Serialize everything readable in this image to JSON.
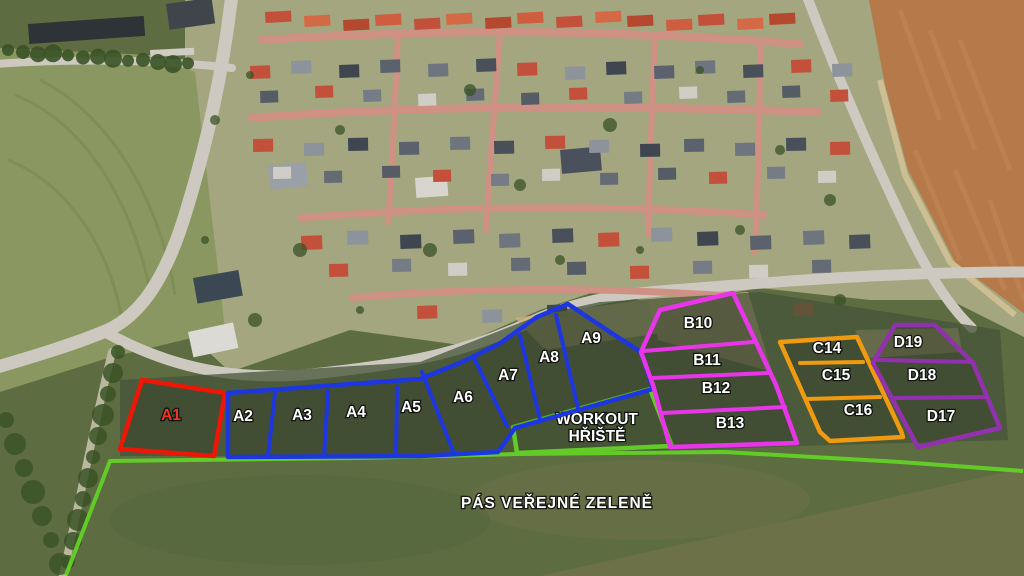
{
  "map": {
    "type": "aerial-parcel-plan",
    "overlay": {
      "parcel_groups": [
        {
          "id": "A-red",
          "color": "#ee1606",
          "label_color": "#f43418",
          "outline": [
            [
              142,
              380
            ],
            [
              225,
              393
            ],
            [
              214,
              456
            ],
            [
              120,
              449
            ]
          ],
          "dividers": [],
          "labels": [
            {
              "text": "A1",
              "xy": [
                171,
                420
              ]
            }
          ]
        },
        {
          "id": "A-blue",
          "color": "#1d36df",
          "label_color": "#ffffff",
          "outline": [
            [
              228,
              393
            ],
            [
              420,
              379
            ],
            [
              462,
              362
            ],
            [
              499,
              344
            ],
            [
              537,
              317
            ],
            [
              568,
              304
            ],
            [
              613,
              334
            ],
            [
              641,
              352
            ],
            [
              653,
              389
            ],
            [
              515,
              428
            ],
            [
              498,
              452
            ],
            [
              420,
              456
            ],
            [
              228,
              457
            ]
          ],
          "dividers": [
            [
              [
                275,
                393
              ],
              [
                268,
                456
              ]
            ],
            [
              [
                328,
                391
              ],
              [
                324,
                456
              ]
            ],
            [
              [
                397,
                387
              ],
              [
                396,
                455
              ]
            ],
            [
              [
                422,
                372
              ],
              [
                453,
                451
              ]
            ],
            [
              [
                473,
                356
              ],
              [
                507,
                426
              ]
            ],
            [
              [
                520,
                335
              ],
              [
                540,
                420
              ]
            ],
            [
              [
                556,
                315
              ],
              [
                578,
                408
              ]
            ]
          ],
          "labels": [
            {
              "text": "A2",
              "xy": [
                243,
                421
              ]
            },
            {
              "text": "A3",
              "xy": [
                302,
                420
              ]
            },
            {
              "text": "A4",
              "xy": [
                356,
                417
              ]
            },
            {
              "text": "A5",
              "xy": [
                411,
                412
              ]
            },
            {
              "text": "A6",
              "xy": [
                463,
                402
              ]
            },
            {
              "text": "A7",
              "xy": [
                508,
                380
              ]
            },
            {
              "text": "A8",
              "xy": [
                549,
                362
              ]
            },
            {
              "text": "A9",
              "xy": [
                591,
                343
              ]
            }
          ]
        },
        {
          "id": "B-magenta",
          "color": "#e935e9",
          "label_color": "#ffffff",
          "outline": [
            [
              660,
              310
            ],
            [
              733,
              293
            ],
            [
              776,
              385
            ],
            [
              797,
              443
            ],
            [
              670,
              447
            ],
            [
              653,
              385
            ],
            [
              641,
              352
            ]
          ],
          "dividers": [
            [
              [
                644,
                351
              ],
              [
                753,
                342
              ]
            ],
            [
              [
                652,
                378
              ],
              [
                768,
                373
              ]
            ],
            [
              [
                662,
                413
              ],
              [
                785,
                407
              ]
            ]
          ],
          "labels": [
            {
              "text": "B10",
              "xy": [
                698,
                328
              ]
            },
            {
              "text": "B11",
              "xy": [
                707,
                365
              ]
            },
            {
              "text": "B12",
              "xy": [
                716,
                393
              ]
            },
            {
              "text": "B13",
              "xy": [
                730,
                428
              ]
            }
          ]
        },
        {
          "id": "C-orange",
          "color": "#f09a10",
          "label_color": "#ffffff",
          "outline": [
            [
              780,
              342
            ],
            [
              857,
              337
            ],
            [
              901,
              431
            ],
            [
              903,
              437
            ],
            [
              830,
              441
            ],
            [
              820,
              432
            ]
          ],
          "dividers": [
            [
              [
                800,
                363
              ],
              [
                863,
                362
              ]
            ],
            [
              [
                807,
                399
              ],
              [
                880,
                397
              ]
            ]
          ],
          "labels": [
            {
              "text": "C14",
              "xy": [
                827,
                353
              ]
            },
            {
              "text": "C15",
              "xy": [
                836,
                380
              ]
            },
            {
              "text": "C16",
              "xy": [
                858,
                415
              ]
            }
          ]
        },
        {
          "id": "D-purple",
          "color": "#9231ae",
          "label_color": "#ffffff",
          "outline": [
            [
              895,
              325
            ],
            [
              935,
              325
            ],
            [
              973,
              363
            ],
            [
              1000,
              428
            ],
            [
              918,
              447
            ],
            [
              873,
              363
            ]
          ],
          "dividers": [
            [
              [
                877,
                360
              ],
              [
                973,
                362
              ]
            ],
            [
              [
                895,
                398
              ],
              [
                987,
                397
              ]
            ]
          ],
          "labels": [
            {
              "text": "D19",
              "xy": [
                908,
                347
              ]
            },
            {
              "text": "D18",
              "xy": [
                922,
                380
              ]
            },
            {
              "text": "D17",
              "xy": [
                941,
                421
              ]
            }
          ]
        }
      ],
      "workout_area": {
        "color": "#63cb28",
        "outline": [
          [
            513,
            427
          ],
          [
            650,
            389
          ],
          [
            672,
            446
          ],
          [
            517,
            453
          ]
        ],
        "label_lines": [
          "WORKOUT",
          "HŘIŠTĚ"
        ],
        "label_xy": [
          597,
          428
        ]
      },
      "green_belt": {
        "color": "#63cb28",
        "line": [
          [
            66,
            575
          ],
          [
            110,
            461
          ],
          [
            360,
            458
          ],
          [
            517,
            454
          ],
          [
            724,
            452
          ],
          [
            900,
            462
          ],
          [
            1023,
            471
          ]
        ],
        "label": "PÁS VEŘEJNÉ ZELENĚ",
        "label_xy": [
          557,
          508
        ]
      }
    },
    "scene_palette": {
      "meadow": "#5d6c41",
      "meadow_right": "#77744c",
      "parcel_ground": "#45543a",
      "field": "#8b9760",
      "field_stripe": "#7d8b54",
      "farmland": "#b5794a",
      "farmland_stripe": "#c08354",
      "neighborhood": "#a3a67f",
      "road_asphalt": "#cdc9c0",
      "road_brick": "#cf9184",
      "path_tan": "#d7c49a",
      "trees": "#3a5226",
      "sand": "#c9b083",
      "building_dark": "#2e3338",
      "roofs_red": [
        "#c2503a",
        "#cf5d3f",
        "#b4492f",
        "#d46a45"
      ],
      "roofs_mix": [
        "#5b626d",
        "#6e757f",
        "#49505a",
        "#c2503a",
        "#8c939b",
        "#3f4650"
      ],
      "roofs_mix2": [
        "#757c85",
        "#555c66",
        "#d0cdc7",
        "#c2503a",
        "#646b75"
      ]
    }
  }
}
